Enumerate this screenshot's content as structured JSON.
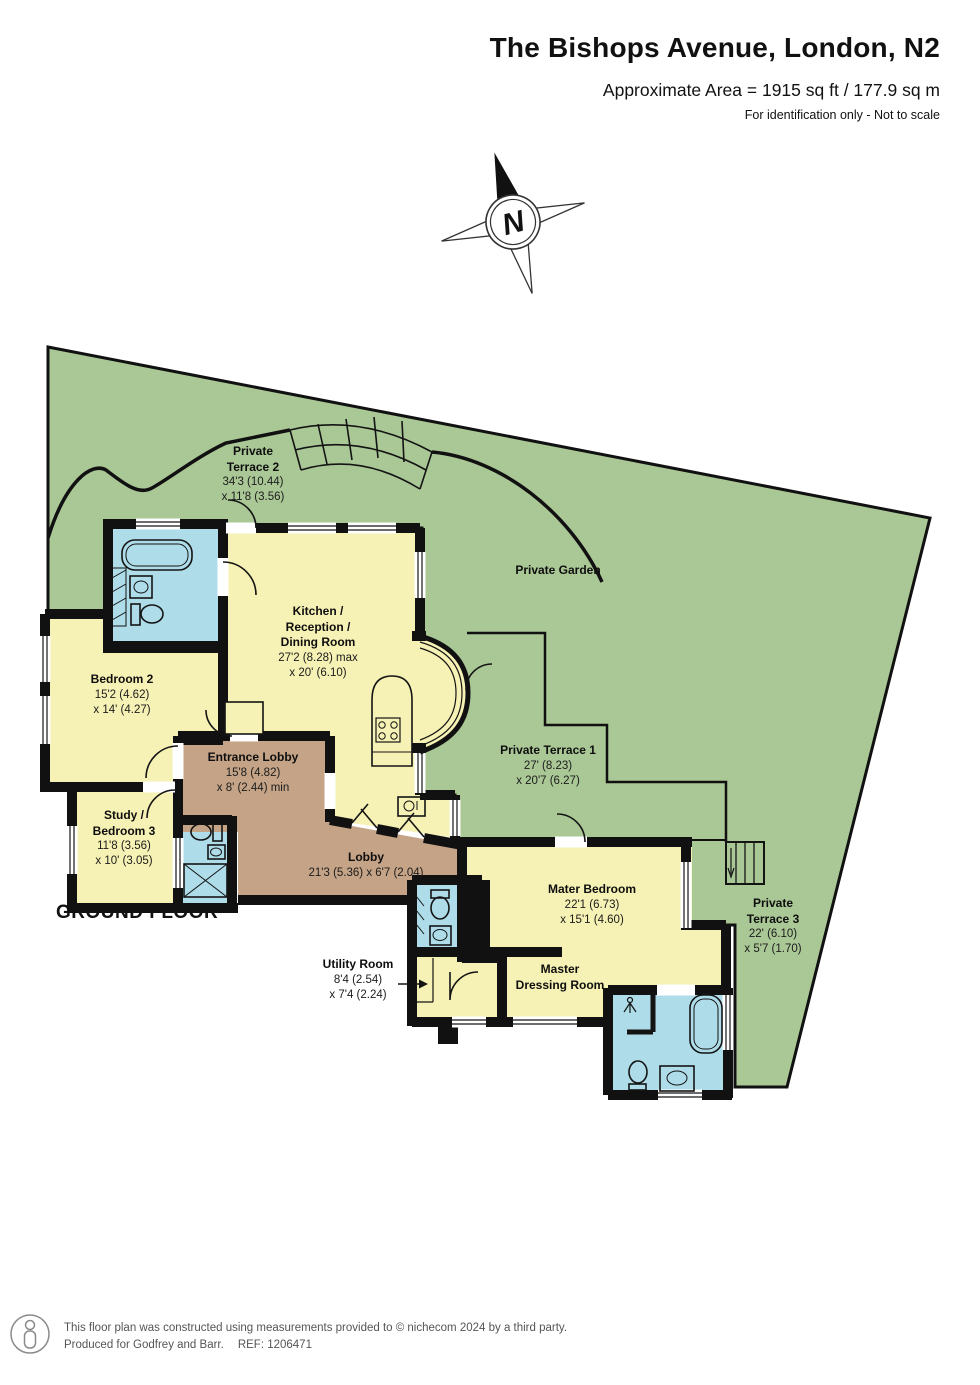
{
  "header": {
    "title": "The Bishops Avenue, London, N2",
    "area": "Approximate Area = 1915 sq ft / 177.9 sq m",
    "note": "For identification only - Not to scale"
  },
  "compass": {
    "north": "N"
  },
  "floor_label": "GROUND FLOOR",
  "rooms": {
    "terrace2": {
      "name1": "Private",
      "name2": "Terrace 2",
      "dim1": "34'3 (10.44)",
      "dim2": "x 11'8 (3.56)"
    },
    "garden": {
      "name": "Private Garden"
    },
    "kitchen": {
      "name1": "Kitchen /",
      "name2": "Reception /",
      "name3": "Dining Room",
      "dim1": "27'2 (8.28) max",
      "dim2": "x 20' (6.10)"
    },
    "bedroom2": {
      "name": "Bedroom 2",
      "dim1": "15'2 (4.62)",
      "dim2": "x 14' (4.27)"
    },
    "study": {
      "name1": "Study /",
      "name2": "Bedroom 3",
      "dim1": "11'8 (3.56)",
      "dim2": "x 10' (3.05)"
    },
    "entrance_lobby": {
      "name": "Entrance Lobby",
      "dim1": "15'8 (4.82)",
      "dim2": "x 8' (2.44) min"
    },
    "lobby": {
      "name": "Lobby",
      "dim1": "21'3 (5.36) x 6'7 (2.04)"
    },
    "terrace1": {
      "name": "Private Terrace 1",
      "dim1": "27' (8.23)",
      "dim2": "x 20'7 (6.27)"
    },
    "master_bedroom": {
      "name": "Mater Bedroom",
      "dim1": "22'1 (6.73)",
      "dim2": "x 15'1 (4.60)"
    },
    "terrace3": {
      "name1": "Private",
      "name2": "Terrace 3",
      "dim1": "22' (6.10)",
      "dim2": "x 5'7 (1.70)"
    },
    "utility": {
      "name": "Utility Room",
      "dim1": "8'4 (2.54)",
      "dim2": "x 7'4 (2.24)"
    },
    "dressing": {
      "name1": "Master",
      "name2": "Dressing Room"
    }
  },
  "footer": {
    "line1": "This floor plan was constructed using measurements provided to © nichecom 2024 by a third party.",
    "line2": "Produced for Godfrey and Barr.",
    "ref": "REF: 1206471"
  },
  "colors": {
    "garden": "#aac796",
    "room": "#f6f1b4",
    "hall": "#c4a386",
    "bath": "#aedce9",
    "wall": "#111111"
  }
}
